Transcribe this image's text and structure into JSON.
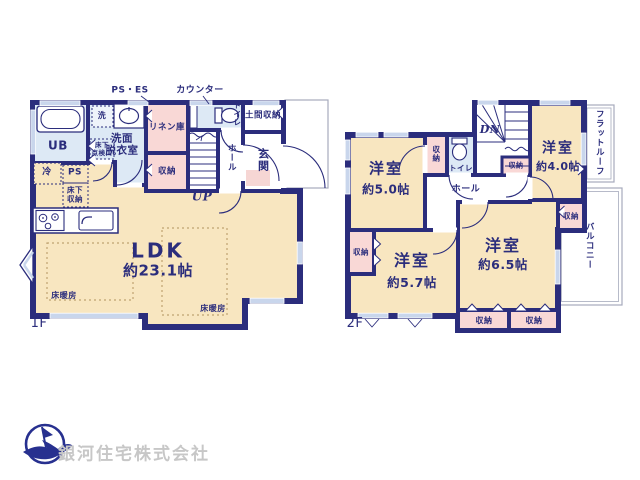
{
  "colors": {
    "wall": "#2b2d7c",
    "room_cream": "#f8e6c0",
    "closet_pink": "#f9d8d6",
    "wet_blue": "#dde9f5",
    "window_blue": "#c9d6ec",
    "outline_gray": "#a6aabc",
    "heating_dot": "#bfa271",
    "logo_navy": "#27308f",
    "company_gray": "#c7c7c7"
  },
  "floor1": {
    "floor_label": "1F",
    "ann_ps_es": "PS・ES",
    "ann_counter": "カウンター",
    "up": "UP",
    "ub": "UB",
    "washer": "洗",
    "uf_access1": "床下",
    "uf_access2": "点検口",
    "washroom1": "洗面",
    "washroom2": "脱衣室",
    "linen": "リネン庫",
    "toilet": "トイレ",
    "doma": "土間収納",
    "genkan": "玄関",
    "hall": "ホール",
    "fridge": "冷",
    "ps": "PS",
    "uf_storage1": "床下",
    "uf_storage2": "収納",
    "ldk": "LDK",
    "ldk_size": "約23.1帖",
    "heating": "床暖房"
  },
  "floor2": {
    "floor_label": "2F",
    "dn": "DN",
    "yoshitsu": "洋室",
    "size50": "約5.0帖",
    "size40": "約4.0帖",
    "size57": "約5.7帖",
    "size65": "約6.5帖",
    "toilet": "トイレ",
    "hall": "ホール",
    "flat_roof": "フラットルーフ",
    "balcony": "バルコニー"
  },
  "shared": {
    "storage": "収納"
  },
  "footer": {
    "company": "銀河住宅株式会社"
  }
}
